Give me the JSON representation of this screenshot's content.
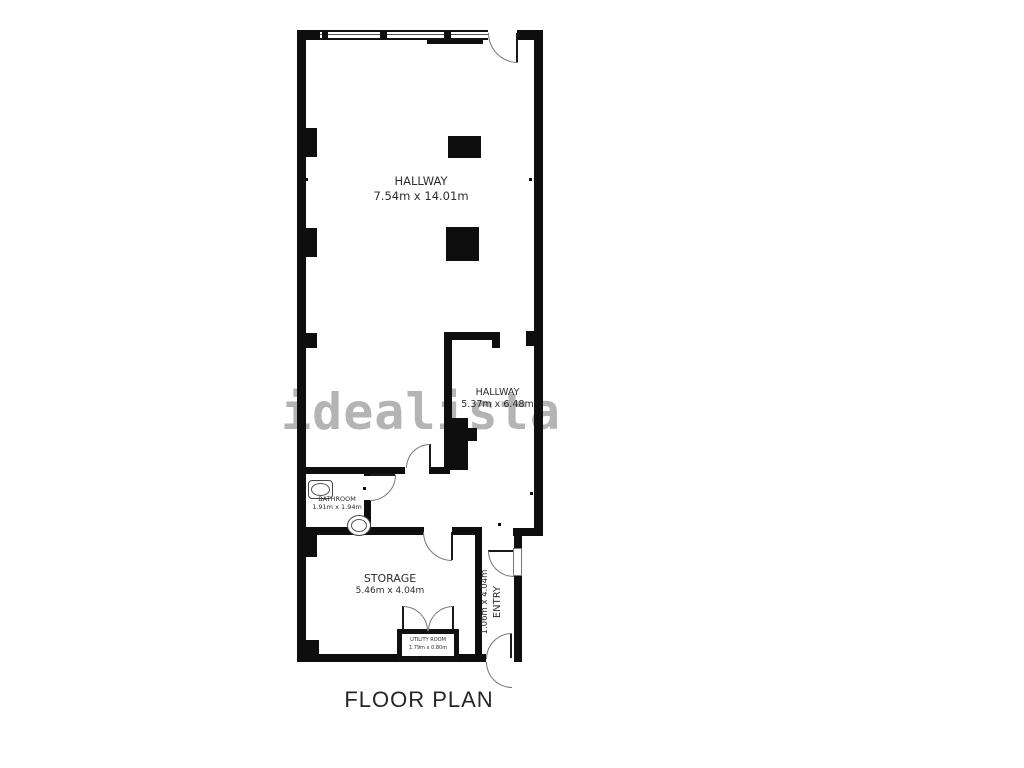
{
  "title": "FLOOR PLAN",
  "watermark": "idealista",
  "colors": {
    "wall": "#0e0e0e",
    "label_text": "#2d2d2d",
    "watermark_gray": "#b4b4b4",
    "background": "#ffffff"
  },
  "rooms": {
    "hallway1": {
      "name": "HALLWAY",
      "dims": "7.54m x 14.01m"
    },
    "hallway2": {
      "name": "HALLWAY",
      "dims": "5.37m x 6.48m"
    },
    "bathroom": {
      "name": "BATHROOM",
      "dims": "1.91m x 1.94m"
    },
    "storage": {
      "name": "STORAGE",
      "dims": "5.46m x 4.04m"
    },
    "entry": {
      "name": "ENTRY",
      "dims": "1.06m x 4.04m"
    },
    "utility": {
      "name": "UTILITY ROOM",
      "dims": "1.79m x 0.80m"
    }
  }
}
